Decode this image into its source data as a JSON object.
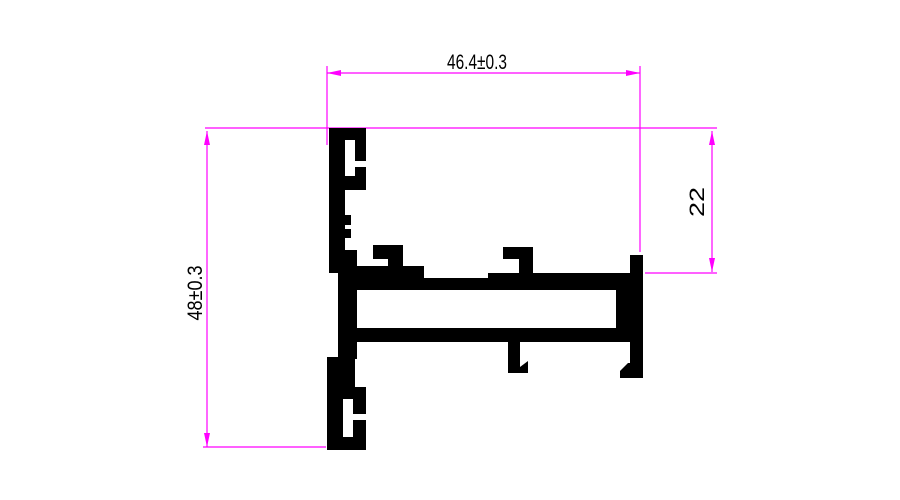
{
  "drawing": {
    "dimensions": {
      "width": {
        "label": "46.4±0.3"
      },
      "height": {
        "label": "48±0.3"
      },
      "right_height": {
        "label": "22"
      }
    },
    "colors": {
      "dimension": "#FF00FF",
      "profile": "#000000",
      "text": "#000000",
      "background": "#FFFFFF"
    }
  }
}
